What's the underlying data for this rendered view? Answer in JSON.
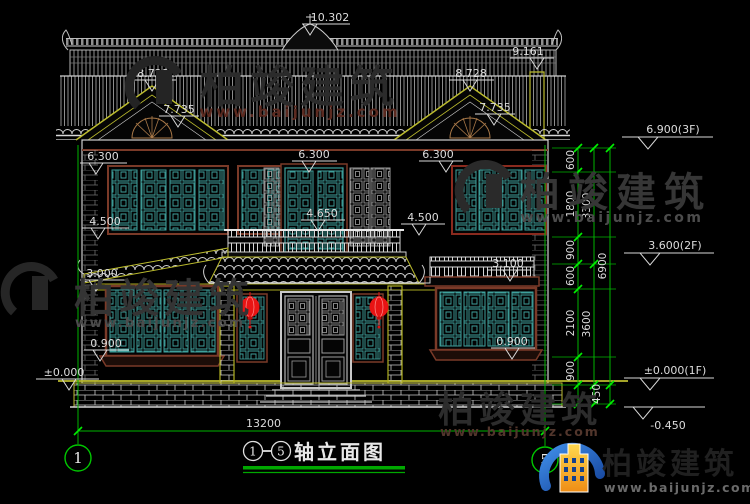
{
  "colors": {
    "background": "#000000",
    "linework_white": "#d9d9d9",
    "window_teal": "#3fa09c",
    "frame_brown": "#7a3a28",
    "accent_yellow": "#bcbc2e",
    "dimension_green": "#00b400",
    "tick_green": "#00ee00",
    "lantern_red": "#e81414",
    "logo_blue": "#2268cc",
    "logo_orange": "#f5a623"
  },
  "markers": {
    "ridge": "10.302",
    "ridge_right": "9.161",
    "gable_peak_left": "8.728",
    "gable_base_left": "7.735",
    "gable_peak_right": "8.728",
    "gable_base_right": "7.735",
    "win2f_top_left": "6.300",
    "win2f_top_center": "6.300",
    "win2f_top_right": "6.300",
    "win2f_sill_left": "4.500",
    "balcony_rail": "4.650",
    "eave_center_right": "4.500",
    "win1f_top_left": "3.000",
    "win1f_top_right": "3.100",
    "win1f_sill_left": "0.900",
    "win1f_sill_right": "0.900",
    "ground_left": "±0.000",
    "level_3f": "6.900(3F)",
    "level_2f": "3.600(2F)",
    "level_1f": "±0.000(1F)",
    "level_base": "-0.450"
  },
  "chain": {
    "seg1": "600",
    "seg2": "1800",
    "seg3": "900",
    "seg4": "600",
    "seg5": "2100",
    "seg6": "900",
    "seg7": "450",
    "sub1": "3300",
    "sub2": "3600",
    "total": "6900"
  },
  "bottom": {
    "width": "13200",
    "axis_left": "1",
    "axis_right": "5"
  },
  "title": {
    "from": "1",
    "dash": "-",
    "to": "5",
    "name": "轴立面图"
  },
  "watermark": {
    "brand": "柏竣建筑",
    "site": "www.baijunjz.com"
  },
  "logo": {
    "brand": "柏竣建筑",
    "site": "www.baijunjz.com"
  }
}
